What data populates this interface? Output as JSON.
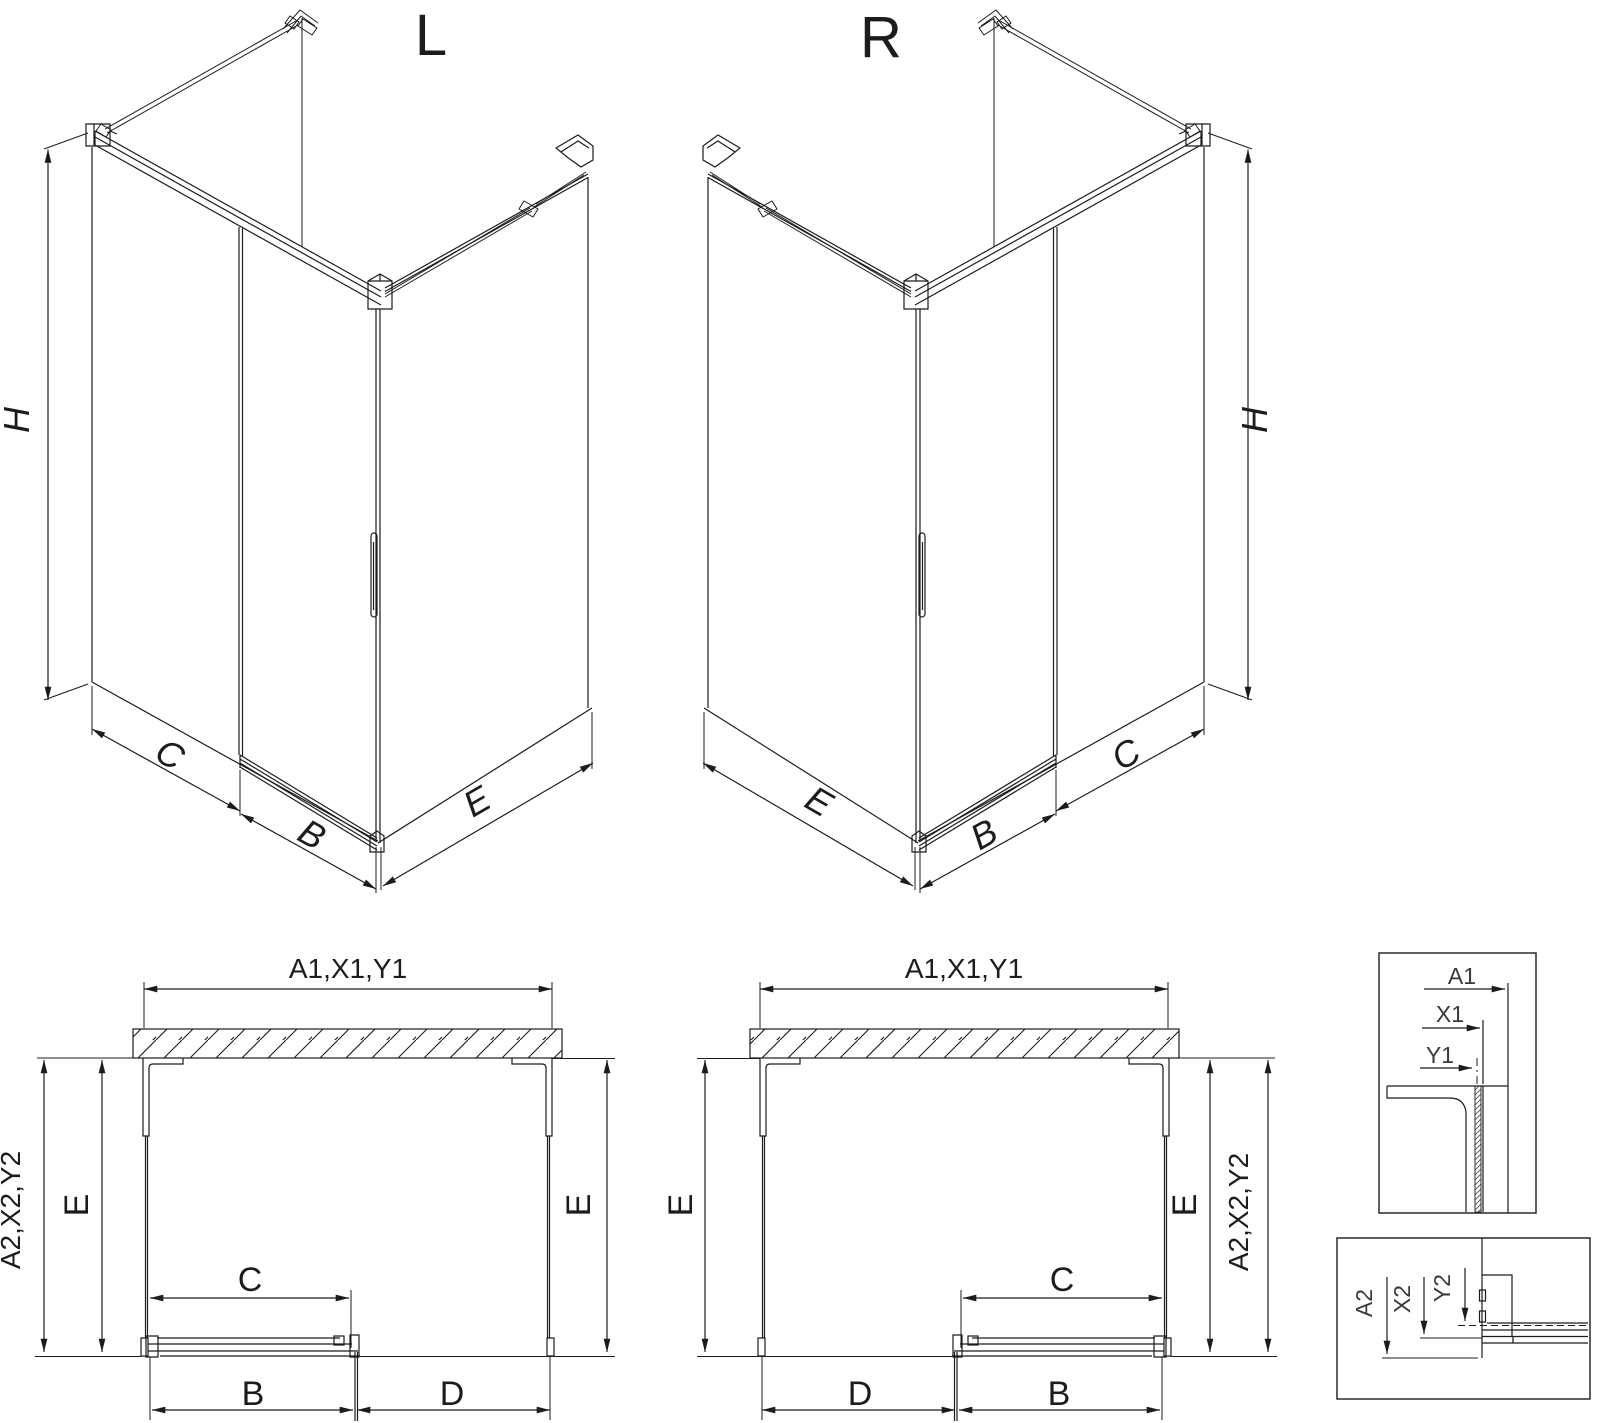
{
  "colors": {
    "line": "#1c1c1c",
    "background": "#ffffff"
  },
  "views": {
    "iso_left": {
      "label": "L",
      "dim_height": "H",
      "dim_fixed": "C",
      "dim_door": "B",
      "dim_side": "E"
    },
    "iso_right": {
      "label": "R",
      "dim_height": "H",
      "dim_fixed": "C",
      "dim_door": "B",
      "dim_side": "E"
    },
    "plan_left": {
      "dim_width": "A1,X1,Y1",
      "dim_depth_outer": "A2,X2,Y2",
      "dim_depth_left": "E",
      "dim_depth_right": "E",
      "dim_fixed": "C",
      "dim_door": "B",
      "dim_opening": "D"
    },
    "plan_right": {
      "dim_width": "A1,X1,Y1",
      "dim_depth_outer": "A2,X2,Y2",
      "dim_depth_left": "E",
      "dim_depth_right": "E",
      "dim_fixed": "C",
      "dim_door": "B",
      "dim_opening": "D"
    },
    "detail_width": {
      "dim_a": "A1",
      "dim_x": "X1",
      "dim_y": "Y1"
    },
    "detail_depth": {
      "dim_a": "A2",
      "dim_x": "X2",
      "dim_y": "Y2"
    }
  }
}
